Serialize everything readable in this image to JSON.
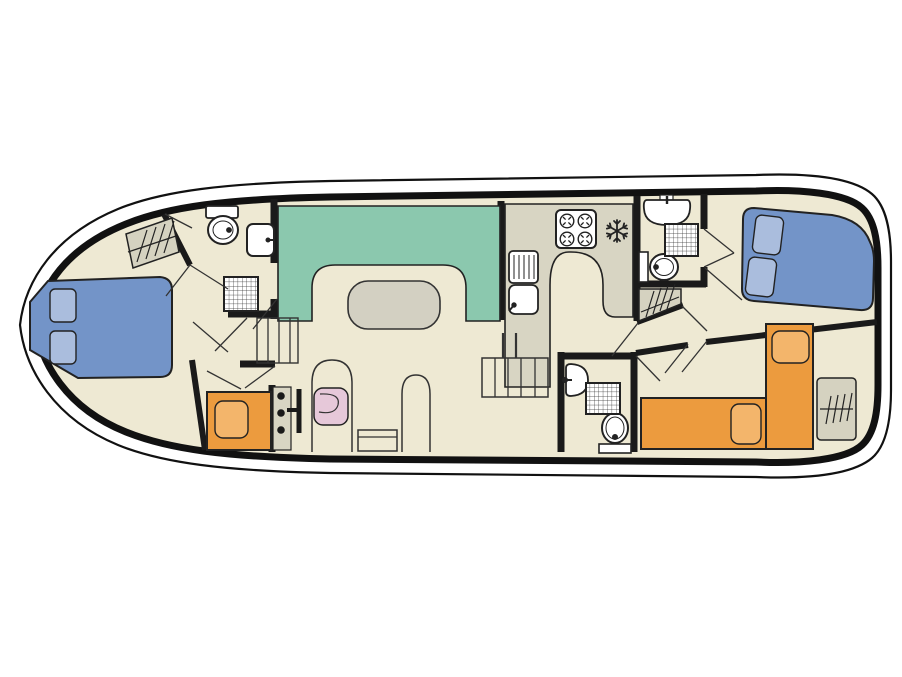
{
  "diagram": {
    "type": "boat-floor-plan",
    "palette": {
      "background": "#FFFFFF",
      "floor": "#EEE9D3",
      "hull_line": "#111111",
      "wall": "#1A1A1A",
      "detail_line": "#333333",
      "sofa_green": "#8BC8AE",
      "table_grey": "#D3D0C2",
      "counter_grey": "#D8D5C3",
      "wardrobe_grey": "#D5D2C0",
      "bed_blue": "#7394C8",
      "pillow_blue": "#AABDDD",
      "bed_orange": "#EC9B3E",
      "pillow_orange": "#F3B56B",
      "chair_pink": "#E6C8D9",
      "fixture_white": "#FFFFFF",
      "fixture_outline": "#222222"
    },
    "rooms": [
      {
        "name": "bow-cabin",
        "items": [
          "double-bed",
          "wardrobe"
        ]
      },
      {
        "name": "forward-bathroom",
        "items": [
          "toilet",
          "washbasin",
          "shower"
        ]
      },
      {
        "name": "saloon",
        "items": [
          "u-shaped-sofa",
          "table"
        ]
      },
      {
        "name": "galley",
        "items": [
          "stove-4-burner",
          "freezer",
          "sink-with-drainer"
        ]
      },
      {
        "name": "mid-bathroom",
        "items": [
          "washbasin",
          "shower",
          "toilet",
          "wardrobe"
        ]
      },
      {
        "name": "aft-cabin",
        "items": [
          "double-bed"
        ]
      },
      {
        "name": "helm-area",
        "items": [
          "console",
          "throttle",
          "pilot-seat",
          "bench"
        ]
      },
      {
        "name": "aft-bathroom",
        "items": [
          "washbasin",
          "shower",
          "toilet"
        ]
      },
      {
        "name": "stern-cabin",
        "items": [
          "single-bed",
          "single-bed",
          "wardrobe"
        ]
      },
      {
        "name": "port-side-cabin",
        "items": [
          "single-bed"
        ]
      },
      {
        "name": "circulation",
        "items": [
          "companionway-steps",
          "bow-steps"
        ]
      }
    ]
  }
}
